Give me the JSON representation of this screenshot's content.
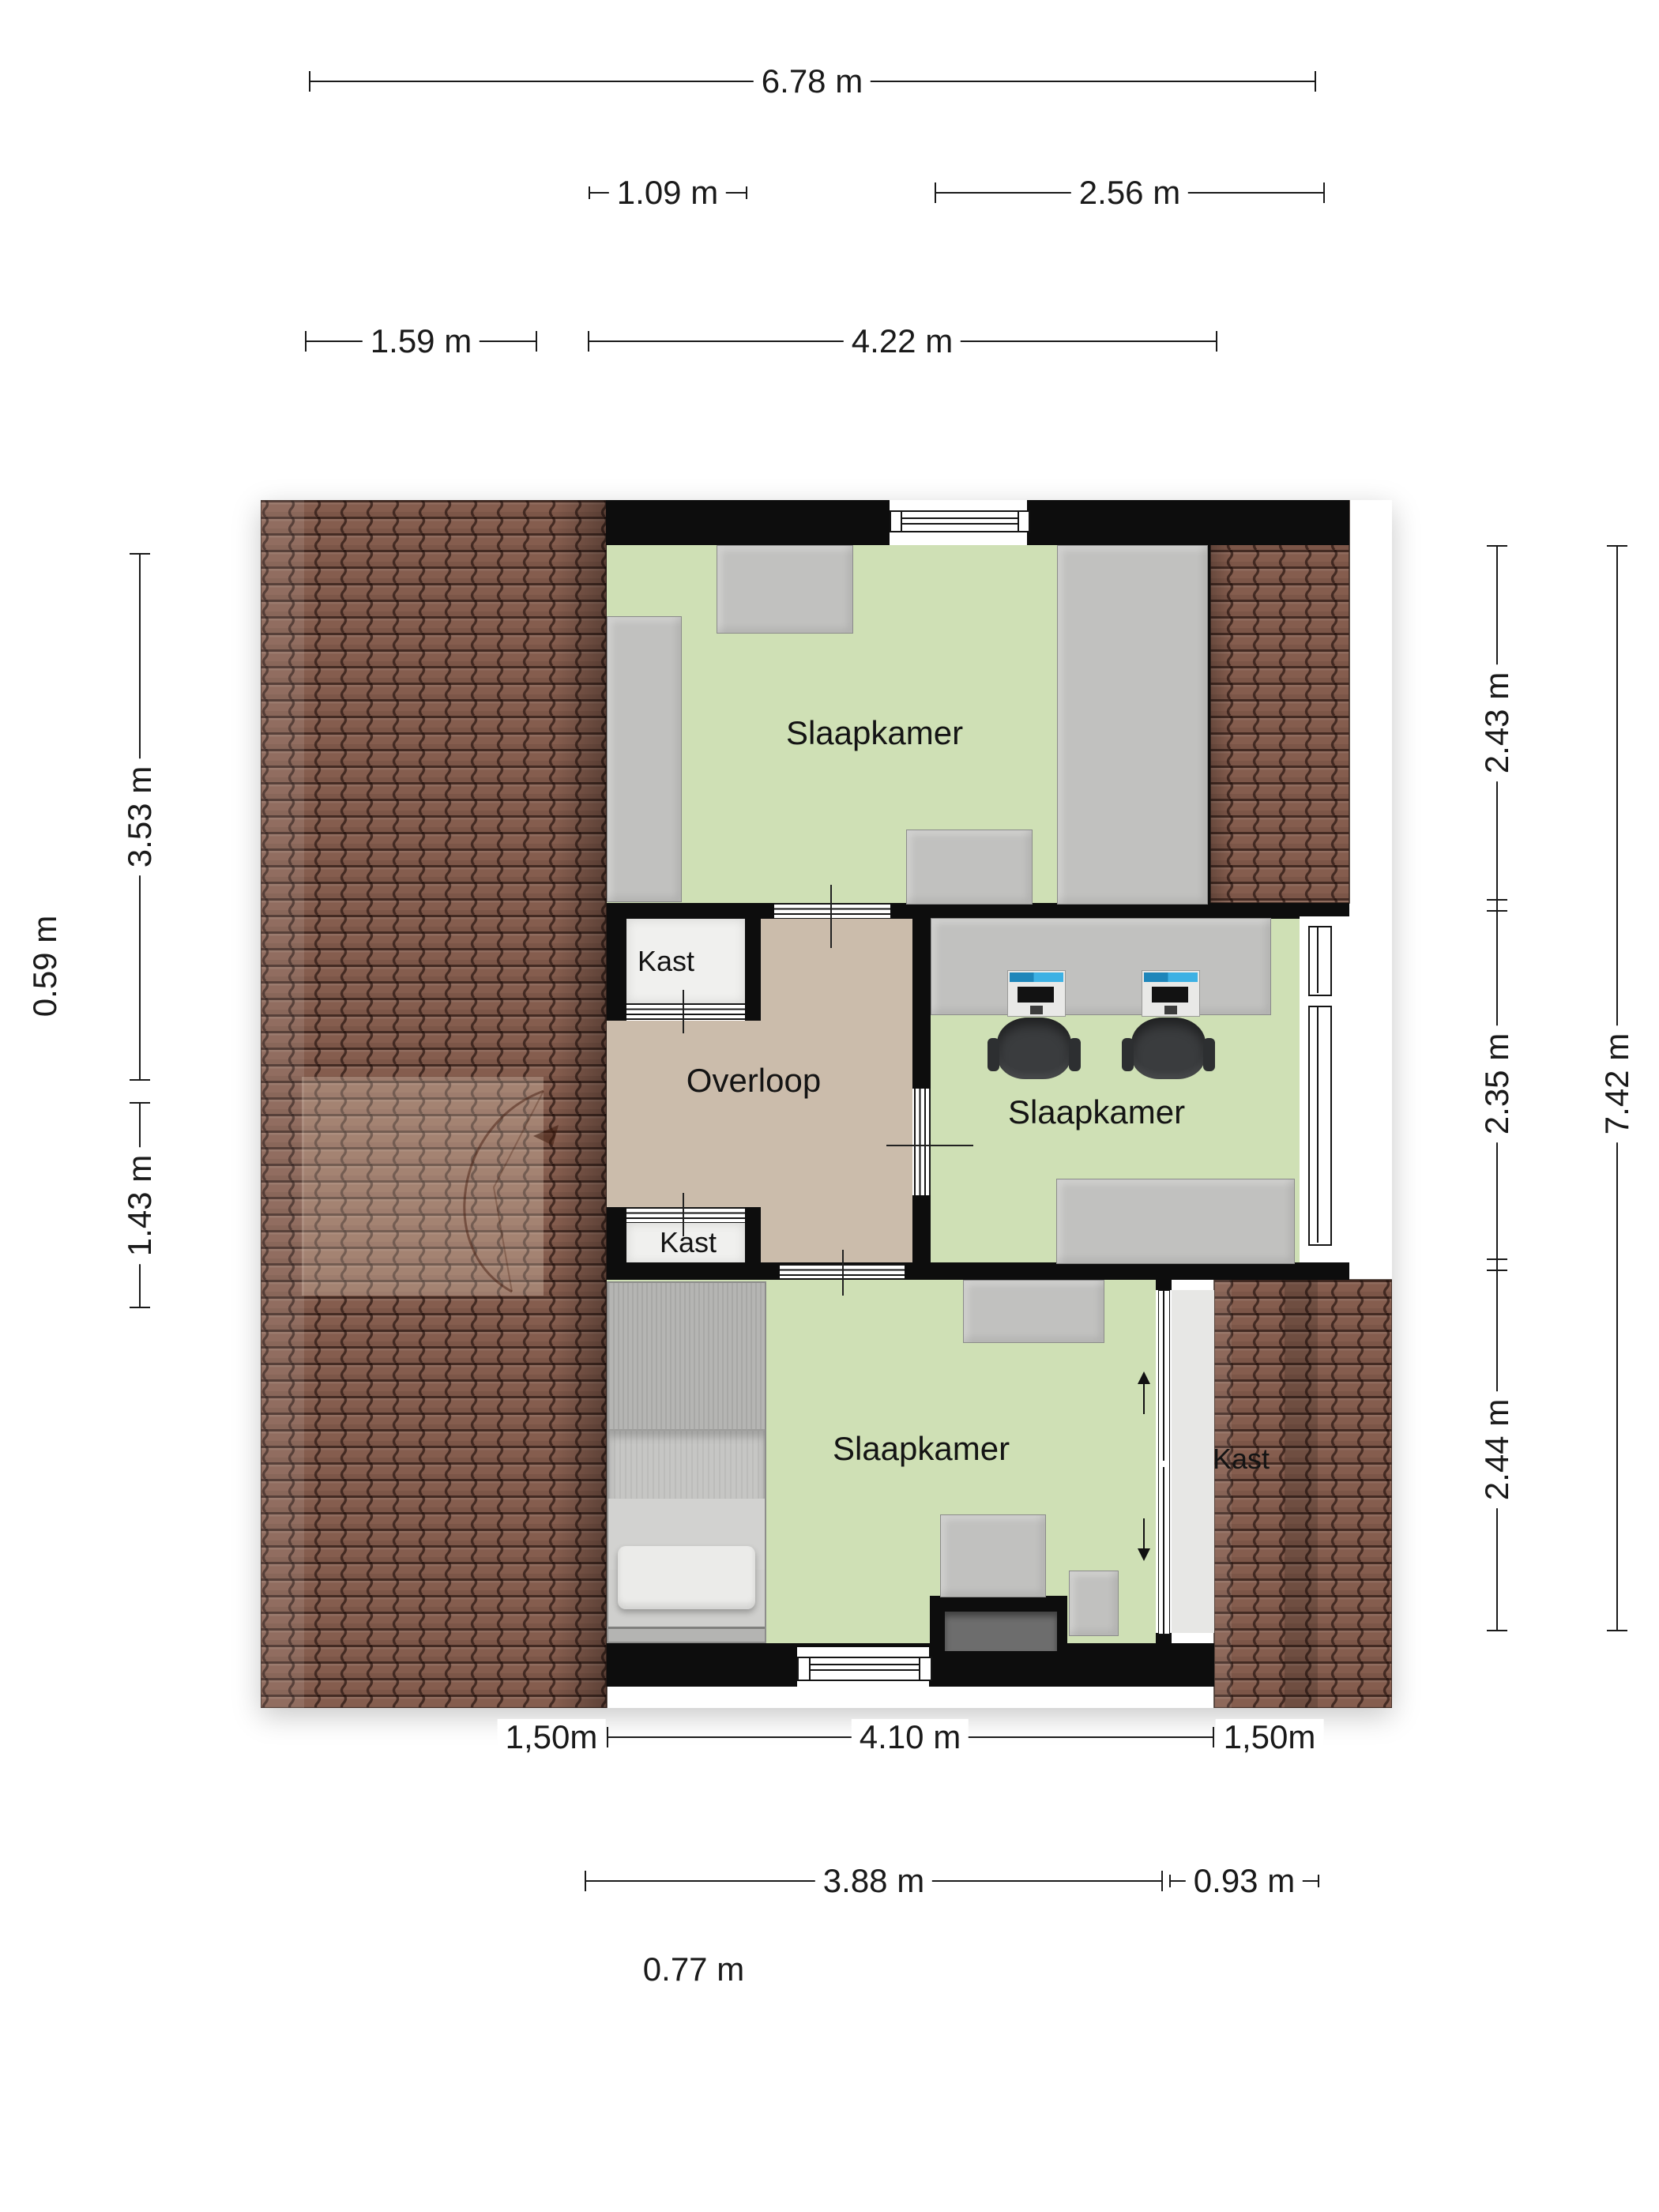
{
  "labels": {
    "bedroom_top": "Slaapkamer",
    "bedroom_mid": "Slaapkamer",
    "bedroom_bottom": "Slaapkamer",
    "closet_upper": "Kast",
    "closet_lower": "Kast",
    "closet_right": "Kast",
    "landing": "Overloop"
  },
  "dimensions": {
    "top_total": "6.78 m",
    "top_row2_left": "1.09 m",
    "top_row2_right": "2.56 m",
    "top_row3_left": "1.59 m",
    "top_row3_right": "4.22 m",
    "left_upper": "3.53 m",
    "left_offset": "0.59 m",
    "left_lower": "1.43 m",
    "right_seg1": "2.43 m",
    "right_seg2": "2.35 m",
    "right_seg3": "2.44 m",
    "right_total": "7.42 m",
    "bottom_left": "1,50m",
    "bottom_center": "4.10 m",
    "bottom_right": "1,50m",
    "bottom_row2_left": "3.88 m",
    "bottom_row2_right": "0.93 m",
    "bottom_row3": "0.77 m"
  },
  "icons": {
    "slide_up": "arrow-up",
    "slide_down": "arrow-down"
  },
  "colors": {
    "floor_green": "#cfe0b5",
    "floor_tan": "#cbbcab",
    "closet_floor": "#f0f0ee",
    "roof_tile": "#855d4e",
    "wall": "#0d0d0d",
    "screen_blue": "#2ea7d8"
  }
}
